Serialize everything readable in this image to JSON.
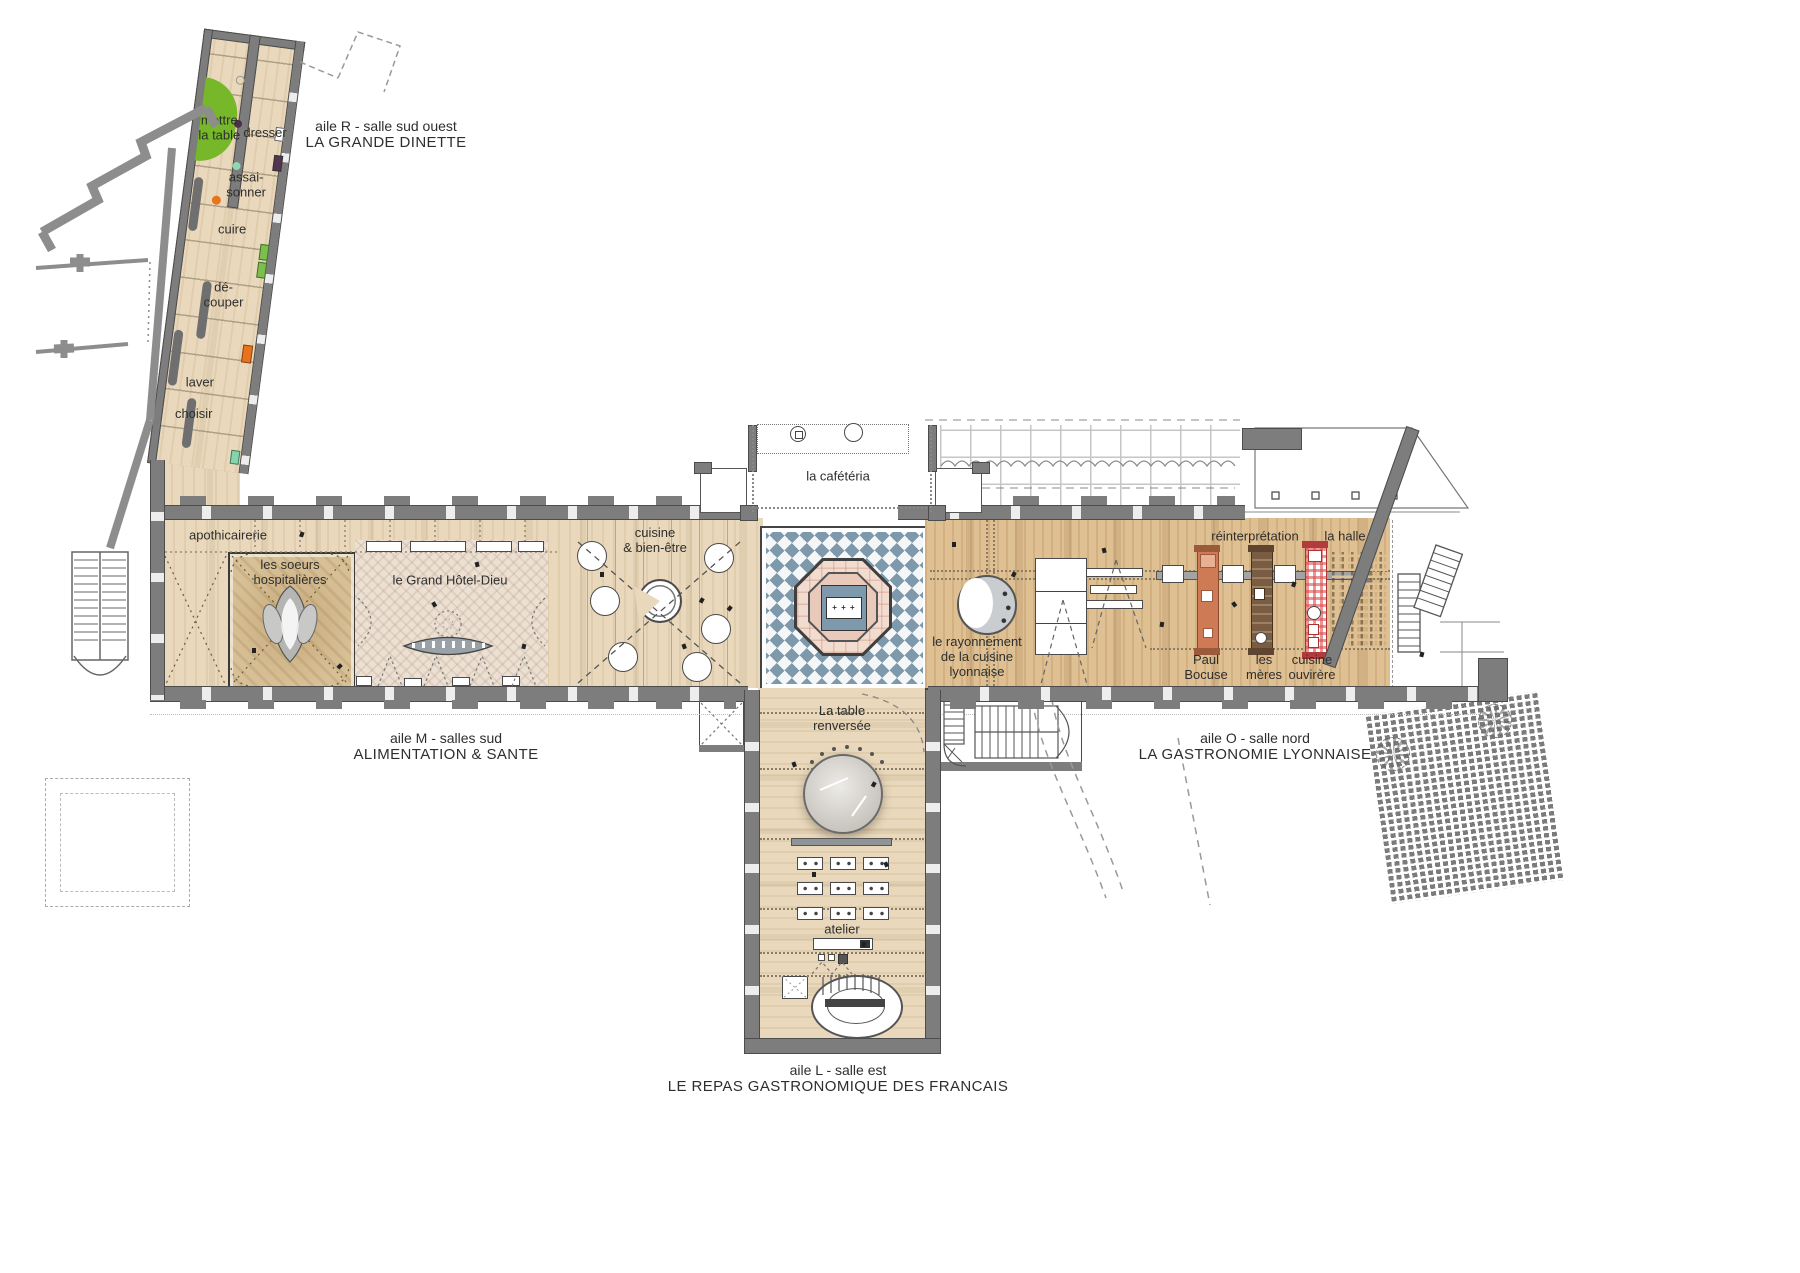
{
  "annotations": {
    "aile_r": {
      "l1": "aile R - salle sud ouest",
      "l2": "LA GRANDE DINETTE"
    },
    "aile_m": {
      "l1": "aile M - salles sud",
      "l2": "ALIMENTATION & SANTE"
    },
    "aile_o": {
      "l1": "aile O - salle nord",
      "l2": "LA GASTRONOMIE LYONNAISE"
    },
    "aile_l": {
      "l1": "aile L - salle est",
      "l2": "LE REPAS GASTRONOMIQUE DES FRANCAIS"
    }
  },
  "rooms": {
    "mettre_la_table": "mettre\nla table",
    "dresser": "dresser",
    "assaisonner": "assai-\nsonner",
    "cuire": "cuire",
    "decouper": "dé-\ncouper",
    "laver": "laver",
    "choisir": "choisir",
    "apothicairerie": "apothicairerie",
    "soeurs": "les soeurs\nhospitalières",
    "grand_hotel_dieu": "le Grand Hôtel-Dieu",
    "cuisine_bien_etre": "cuisine\n& bien-être",
    "cafeteria": "la cafétéria",
    "rayonnement": "le rayonnement\nde la cuisine\nlyonnaise",
    "reinterpretation": "réinterprétation",
    "la_halle": "la halle",
    "paul_bocuse": "Paul\nBocuse",
    "les_meres": "les\nmères",
    "cuisine_ouvriere": "cuisine\nouvirère",
    "table_renversee": "La table\nrenversée",
    "atelier": "atelier"
  },
  "fountain_marker": "+ + +",
  "colors": {
    "wall": "#7d7d7d",
    "ink": "#2e2e2e",
    "wood_light": "#e9d8bb",
    "wood_gold": "#dfc092",
    "chapel": "#d8c096",
    "herringbone": "#ece0d3",
    "tile_blue": "#7e99ab",
    "fountain_pink": "#f2dccf",
    "fountain_pink_mid": "#e8c9ba",
    "accent_green": "#76b82a",
    "strip_orange": "#cd7a55",
    "strip_brown": "#7a5c42",
    "strip_red": "#d94f4f"
  }
}
